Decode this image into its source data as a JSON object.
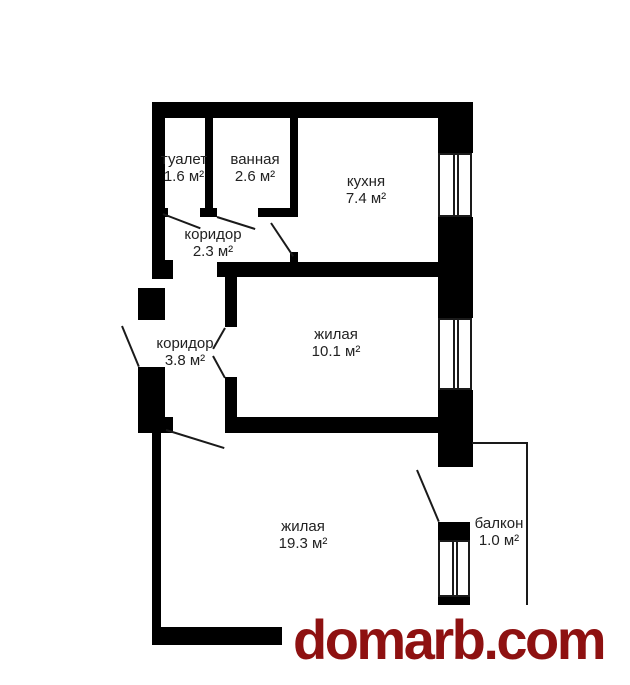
{
  "plan_title": "apartment floor plan",
  "colors": {
    "wall": "#000000",
    "line": "#1a1a1a",
    "label": "#222222",
    "background": "#ffffff",
    "watermark": "#8e1111"
  },
  "rooms": [
    {
      "id": "toilet",
      "name": "туалет",
      "area": "1.6 м²"
    },
    {
      "id": "bathroom",
      "name": "ванная",
      "area": "2.6 м²"
    },
    {
      "id": "kitchen",
      "name": "кухня",
      "area": "7.4 м²"
    },
    {
      "id": "corridor-small",
      "name": "коридор",
      "area": "2.3 м²"
    },
    {
      "id": "corridor-large",
      "name": "коридор",
      "area": "3.8 м²"
    },
    {
      "id": "living-small",
      "name": "жилая",
      "area": "10.1 м²"
    },
    {
      "id": "living-large",
      "name": "жилая",
      "area": "19.3 м²"
    },
    {
      "id": "balcony",
      "name": "балкон",
      "area": "1.0 м²"
    }
  ],
  "watermark": {
    "text": "domarb.com"
  }
}
